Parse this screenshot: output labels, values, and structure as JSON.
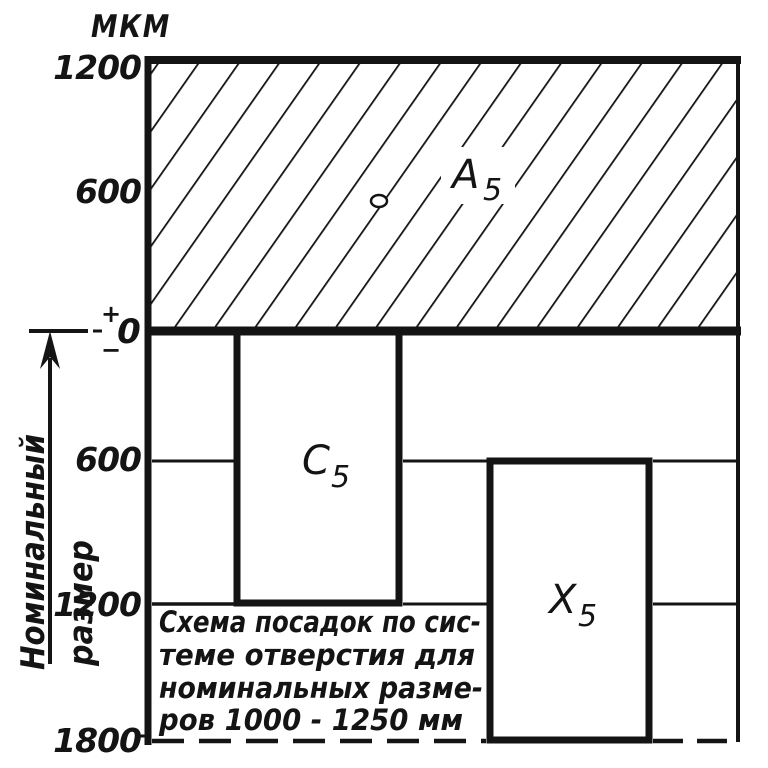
{
  "palette": {
    "ink": "#141414",
    "paper": "#ffffff"
  },
  "axis": {
    "unit_label": "МКМ",
    "tick_top_1200": "1200",
    "tick_top_600": "600",
    "zero_plus": "+",
    "zero_label": "0",
    "zero_minus": "−",
    "tick_bot_600": "600",
    "tick_bot_1200": "1200",
    "tick_bot_1800": "1800"
  },
  "nominal_axis": {
    "word_top": "Номинальный",
    "word_bottom": "размер"
  },
  "zones": {
    "a5": {
      "letter": "А",
      "sub": "5"
    },
    "c5": {
      "letter": "С",
      "sub": "5"
    },
    "x5": {
      "letter": "Х",
      "sub": "5"
    }
  },
  "caption": {
    "line1": "Схема посадок по сис-",
    "line2": "теме отверстия для",
    "line3": "номинальных разме-",
    "line4": "ров 1000 - 1250 мм"
  },
  "chart_data": {
    "type": "tolerance-zone-diagram",
    "unit": "мкм",
    "y_ticks": [
      1200,
      600,
      0,
      -600,
      -1200,
      -1800
    ],
    "zero_line": 0,
    "zones": [
      {
        "name": "А5",
        "upper": 1200,
        "lower": 0,
        "hatched": true
      },
      {
        "name": "С5",
        "upper": 0,
        "lower": -1200,
        "hatched": false
      },
      {
        "name": "Х5",
        "upper": -600,
        "lower": -1800,
        "hatched": false
      }
    ],
    "nominal_axis_label": "Номинальный размер",
    "caption": "Схема посадок по системе отверстия для номинальных размеров 1000 - 1250 мм"
  }
}
